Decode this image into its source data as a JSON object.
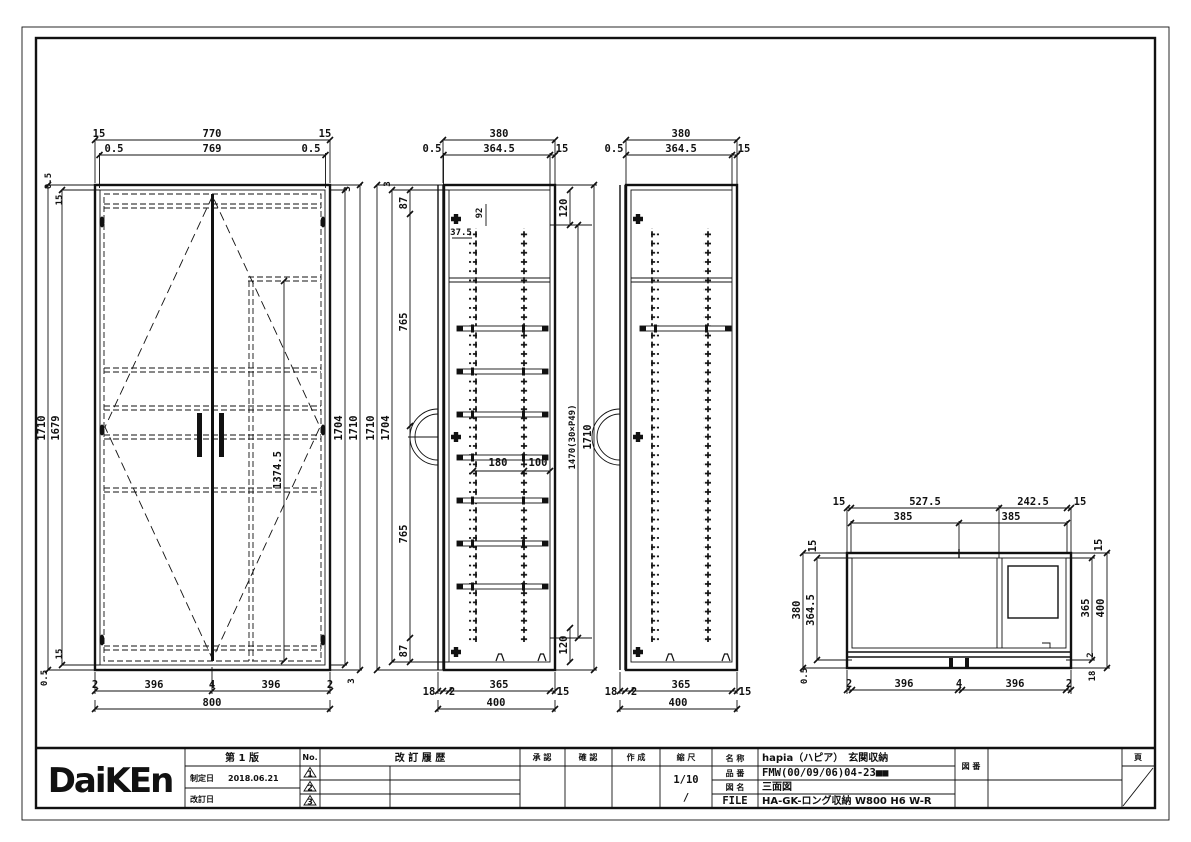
{
  "title_block": {
    "logo": "DaiKEn",
    "edition": "第 1 版",
    "enacted_label": "制定日",
    "enacted_date": "2018.06.21",
    "revised_label": "改訂日",
    "no_label": "No.",
    "rev_marks": {
      "r1": "1",
      "r2": "2",
      "r3": "3"
    },
    "history_header": "改 訂 履 歴",
    "approve_label": "承 認",
    "check_label": "確 認",
    "create_label": "作 成",
    "scale_label": "縮 尺",
    "scale_value": "1/10",
    "scale_value2": "/",
    "name_label": "名 称",
    "name_value": "hapia（ハピア）　玄関収納",
    "part_label": "品 番",
    "part_value": "FMW(00/09/06)04-23■■",
    "fig_label": "図 名",
    "fig_value": "三面図",
    "file_label": "FILE",
    "file_value": "HA-GK-ロング収納 W800 H6 W-R",
    "dwgno_label": "図 番",
    "page_label": "頁"
  },
  "front_view": {
    "t15l": "15",
    "t770": "770",
    "t15r": "15",
    "t05l": "0.5",
    "t769": "769",
    "t05r": "0.5",
    "l1710": "1710",
    "l1679": "1679",
    "lt05": "0.5",
    "lt15": "15",
    "lb15": "15",
    "lb05": "0.5",
    "r3t": "3",
    "r1704": "1704",
    "r1710": "1710",
    "r3b": "3",
    "d1374": "1374.5",
    "b2l": "2",
    "b396l": "396",
    "b4": "4",
    "b396r": "396",
    "b2r": "2",
    "b800": "800"
  },
  "section_a": {
    "t380": "380",
    "t05": "0.5",
    "t3645": "364.5",
    "t15": "15",
    "l3": "3",
    "l1710": "1710",
    "l1704": "1704",
    "c87t": "87",
    "c765t": "765",
    "c765b": "765",
    "c87b": "87",
    "h92": "92",
    "h375": "37.5",
    "r120t": "120",
    "r1470": "1470(30×P49)",
    "r1710": "1710",
    "r120b": "120",
    "m180": "180",
    "m100": "100",
    "b18": "18",
    "b2": "2",
    "b365": "365",
    "b15": "15",
    "b400": "400"
  },
  "section_b": {
    "t380": "380",
    "t05": "0.5",
    "t3645": "364.5",
    "t15": "15",
    "b18": "18",
    "b2": "2",
    "b365": "365",
    "b15": "15",
    "b400": "400"
  },
  "plan_view": {
    "t15l": "15",
    "t5275": "527.5",
    "t2425": "242.5",
    "t15r": "15",
    "t385l": "385",
    "t385r": "385",
    "l15": "15",
    "l380": "380",
    "l3645": "364.5",
    "l05": "0.5",
    "r15": "15",
    "r365": "365",
    "r400": "400",
    "r2": "2",
    "r18": "18",
    "b2l": "2",
    "b396l": "396",
    "b4": "4",
    "b396r": "396",
    "b2r": "2"
  }
}
